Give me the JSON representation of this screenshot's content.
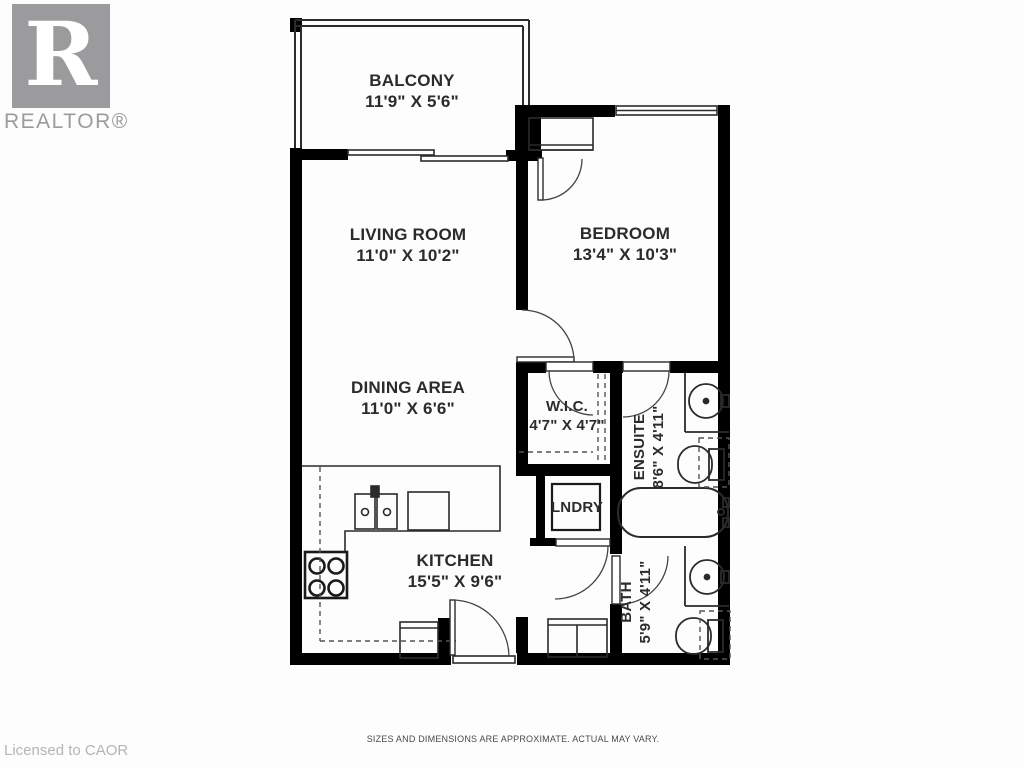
{
  "branding": {
    "logo_letter": "R",
    "logo_text": "REALTOR®"
  },
  "rooms": {
    "balcony": {
      "name": "BALCONY",
      "dims": "11'9\" X 5'6\""
    },
    "living": {
      "name": "LIVING ROOM",
      "dims": "11'0\" X 10'2\""
    },
    "bedroom": {
      "name": "BEDROOM",
      "dims": "13'4\" X 10'3\""
    },
    "dining": {
      "name": "DINING AREA",
      "dims": "11'0\" X 6'6\""
    },
    "wic": {
      "name": "W.I.C.",
      "dims": "4'7\" X 4'7\""
    },
    "ensuite": {
      "name": "ENSUITE",
      "dims": "8'6\" X 4'11\""
    },
    "laundry": {
      "name": "LNDRY"
    },
    "kitchen": {
      "name": "KITCHEN",
      "dims": "15'5\" X 9'6\""
    },
    "bath": {
      "name": "BATH",
      "dims": "5'9\" X 4'11\""
    }
  },
  "footer": {
    "disclaimer": "SIZES AND DIMENSIONS ARE APPROXIMATE. ACTUAL MAY VARY.",
    "licensed": "Licensed to CAOR"
  },
  "colors": {
    "wall": "#000000",
    "line": "#2b2b2b",
    "logo_gray": "#9b9b9d",
    "muted_text": "#b4b4b4"
  }
}
